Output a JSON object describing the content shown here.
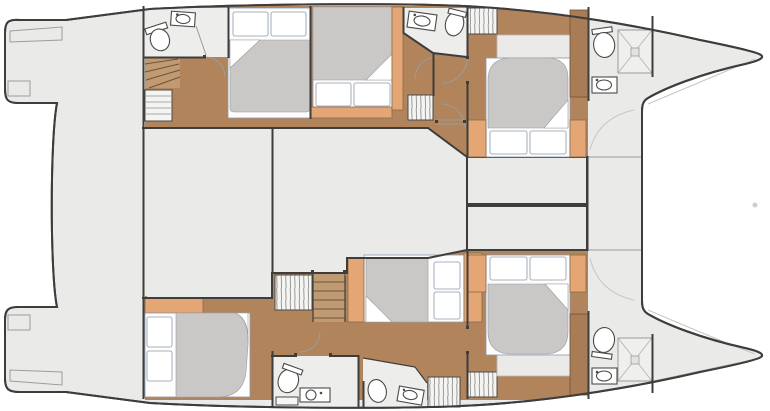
{
  "meta": {
    "kind": "boat-deck-plan",
    "subject": "catamaran interior layout, plan view",
    "orientation": "bow-right, stern-left",
    "visible_text": "none"
  },
  "colors": {
    "background": "#ffffff",
    "deck": "#eaeae9",
    "outline": "#3e3d3b",
    "wood_floor": "#b1845c",
    "wood_steps": "#c09a72",
    "wood_dark": "#a87c54",
    "accent_wood": "#e3a674",
    "mattress": "#c9c8c7",
    "bath_floor": "#ededec",
    "hatch_bg": "#f4f4f3",
    "soft_line": "#9c9c9a",
    "bed_stroke": "#8d99ad"
  },
  "vessel": {
    "center_deck": [
      {
        "name": "transom-platform-port",
        "furniture": [
          "boarding-steps"
        ]
      },
      {
        "name": "transom-platform-starboard",
        "furniture": [
          "boarding-steps"
        ]
      },
      {
        "name": "aft-cockpit",
        "furniture": []
      },
      {
        "name": "saloon-aft",
        "furniture": []
      },
      {
        "name": "saloon-forward",
        "furniture": []
      },
      {
        "name": "forward-seat-1",
        "furniture": []
      },
      {
        "name": "forward-seat-2",
        "furniture": []
      },
      {
        "name": "foredeck",
        "furniture": []
      },
      {
        "name": "trampoline-bay",
        "furniture": [
          "forestay-fitting"
        ]
      }
    ],
    "port_hull": [
      {
        "name": "aft-head",
        "furniture": [
          "toilet",
          "washbasin",
          "shower-partition"
        ]
      },
      {
        "name": "companionway-aft",
        "furniture": [
          "stairs",
          "shelf-wardrobe"
        ]
      },
      {
        "name": "aft-cabin",
        "furniture": [
          "double-bed",
          "two-pillows"
        ]
      },
      {
        "name": "mid-cabin",
        "furniture": [
          "double-bed",
          "two-pillows",
          "headboard-panel"
        ]
      },
      {
        "name": "mid-head",
        "furniture": [
          "toilet",
          "washbasin"
        ]
      },
      {
        "name": "hanging-wardrobe-1",
        "furniture": []
      },
      {
        "name": "hanging-wardrobe-2",
        "furniture": []
      },
      {
        "name": "forward-cabin",
        "furniture": [
          "double-bed",
          "two-pillows",
          "nightstand",
          "nightstand"
        ]
      },
      {
        "name": "forward-head",
        "furniture": [
          "toilet",
          "washbasin",
          "shower-tray",
          "locker"
        ]
      }
    ],
    "starboard_hull": [
      {
        "name": "aft-cabin",
        "furniture": [
          "double-bed",
          "two-pillows",
          "sideboard"
        ]
      },
      {
        "name": "aft-head",
        "furniture": [
          "toilet",
          "washbasin-counter",
          "bench"
        ]
      },
      {
        "name": "companionway",
        "furniture": [
          "stairs",
          "hanging-wardrobe"
        ]
      },
      {
        "name": "mid-cabin",
        "furniture": [
          "double-bed",
          "two-pillows",
          "nightstand",
          "headboard-panel"
        ]
      },
      {
        "name": "mid-head",
        "furniture": [
          "toilet",
          "washbasin"
        ]
      },
      {
        "name": "hanging-wardrobe-1",
        "furniture": []
      },
      {
        "name": "hanging-wardrobe-2",
        "furniture": []
      },
      {
        "name": "forward-cabin",
        "furniture": [
          "double-bed",
          "two-pillows",
          "nightstand",
          "nightstand"
        ]
      },
      {
        "name": "forward-head",
        "furniture": [
          "toilet",
          "washbasin",
          "shower-tray",
          "locker"
        ]
      }
    ],
    "cabin_count": 6,
    "head_count": 6
  }
}
